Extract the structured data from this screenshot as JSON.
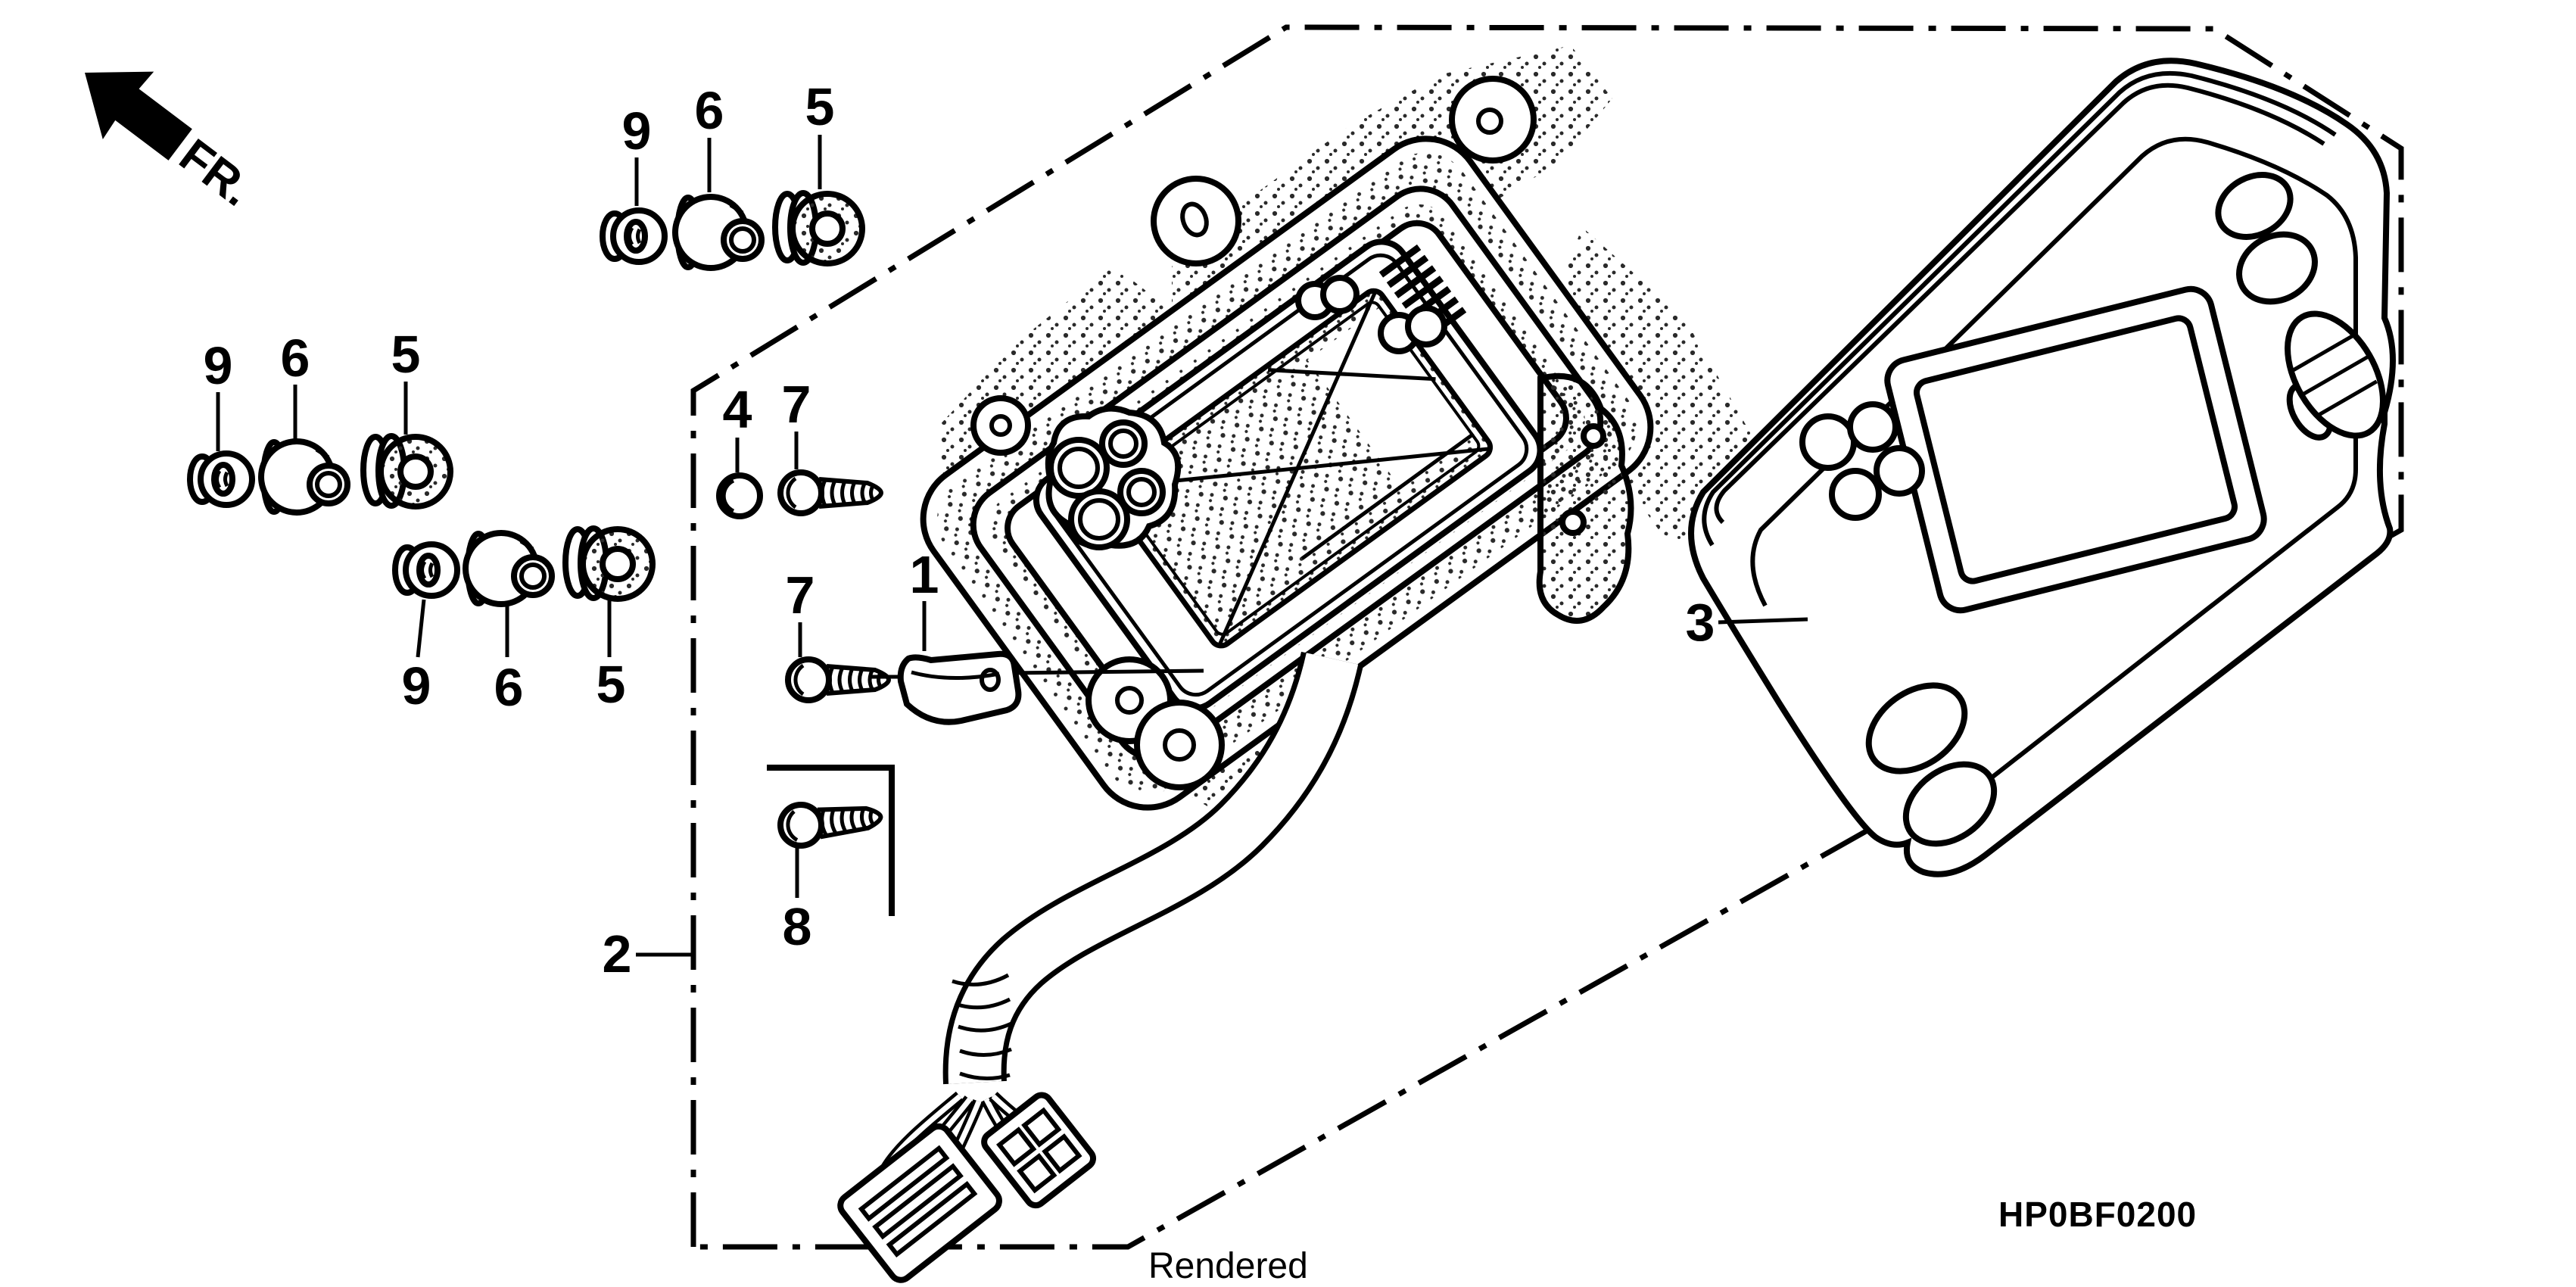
{
  "figure": {
    "type": "exploded-parts-diagram",
    "direction_label": "FR.",
    "watermark": "Rendered",
    "diagram_code": "HP0BF0200",
    "colors": {
      "line": "#000000",
      "background": "#ffffff",
      "stipple": "#2a2a2a"
    },
    "callouts": {
      "group_top": {
        "grommet_small": "9",
        "collar": "6",
        "grommet_large": "5"
      },
      "group_middle": {
        "grommet_small": "9",
        "collar": "6",
        "grommet_large": "5"
      },
      "group_bottom": {
        "grommet_small": "9",
        "collar": "6",
        "grommet_large": "5"
      },
      "cap": "4",
      "screw_upper": "7",
      "screw_lower": "7",
      "cord_clamp": "1",
      "screw_bracket": "8",
      "meter_assembly": "2",
      "meter_cover": "3"
    }
  }
}
